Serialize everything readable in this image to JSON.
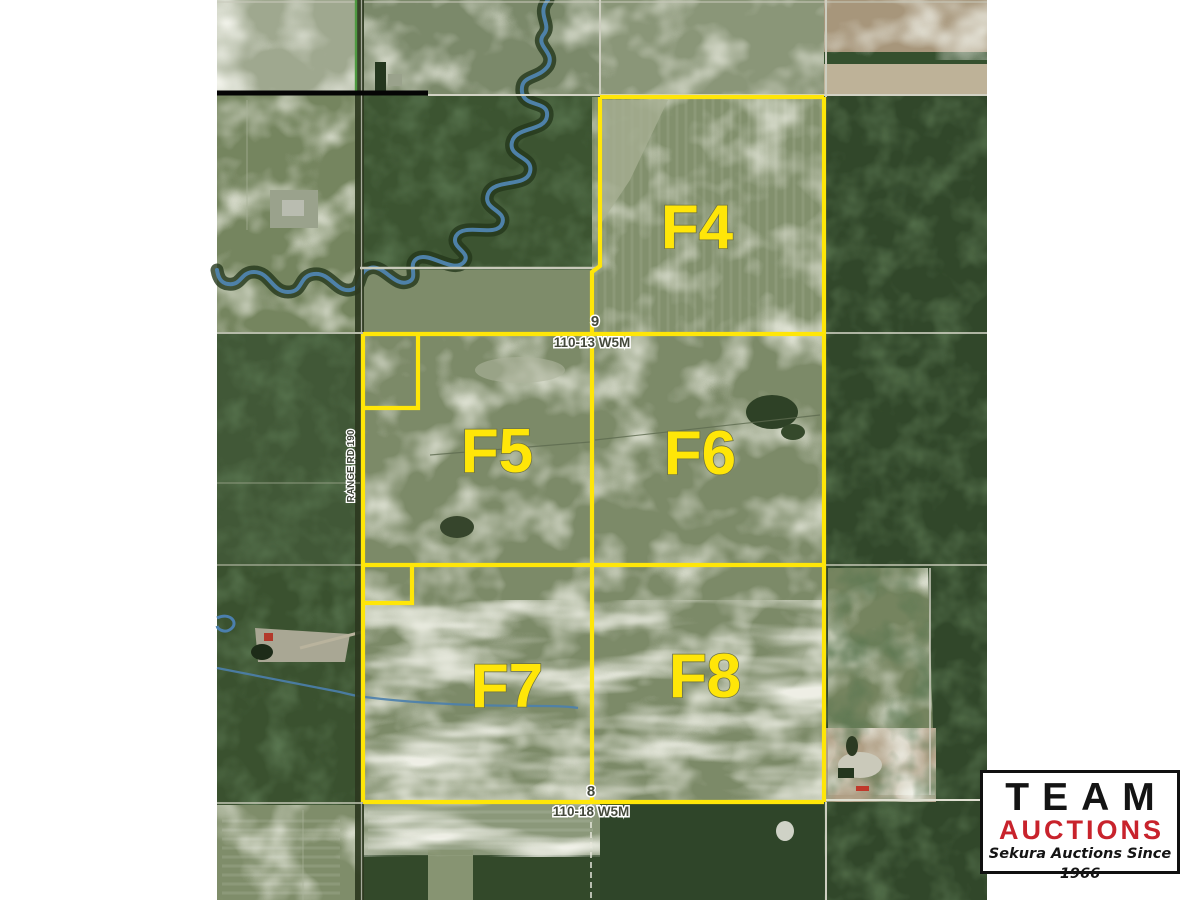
{
  "map": {
    "name": "aerial-parcel-auction-map",
    "parcels": [
      {
        "label": "F4"
      },
      {
        "label": "F5"
      },
      {
        "label": "F6"
      },
      {
        "label": "F7"
      },
      {
        "label": "F8"
      }
    ],
    "section_markers": [
      {
        "section": "9",
        "township": "110-13 W5M",
        "position": "top"
      },
      {
        "section": "8",
        "township": "110-18 W5M",
        "position": "bottom"
      }
    ],
    "road_label": "RANGE RD 190",
    "boundary_color": "#ffe608",
    "parcel_label_color": "#ffe608"
  },
  "logo": {
    "title": "TEAM",
    "subtitle": "AUCTIONS",
    "tagline": "Sekura Auctions Since 1966",
    "title_color": "#141414",
    "subtitle_color": "#c8232c"
  }
}
